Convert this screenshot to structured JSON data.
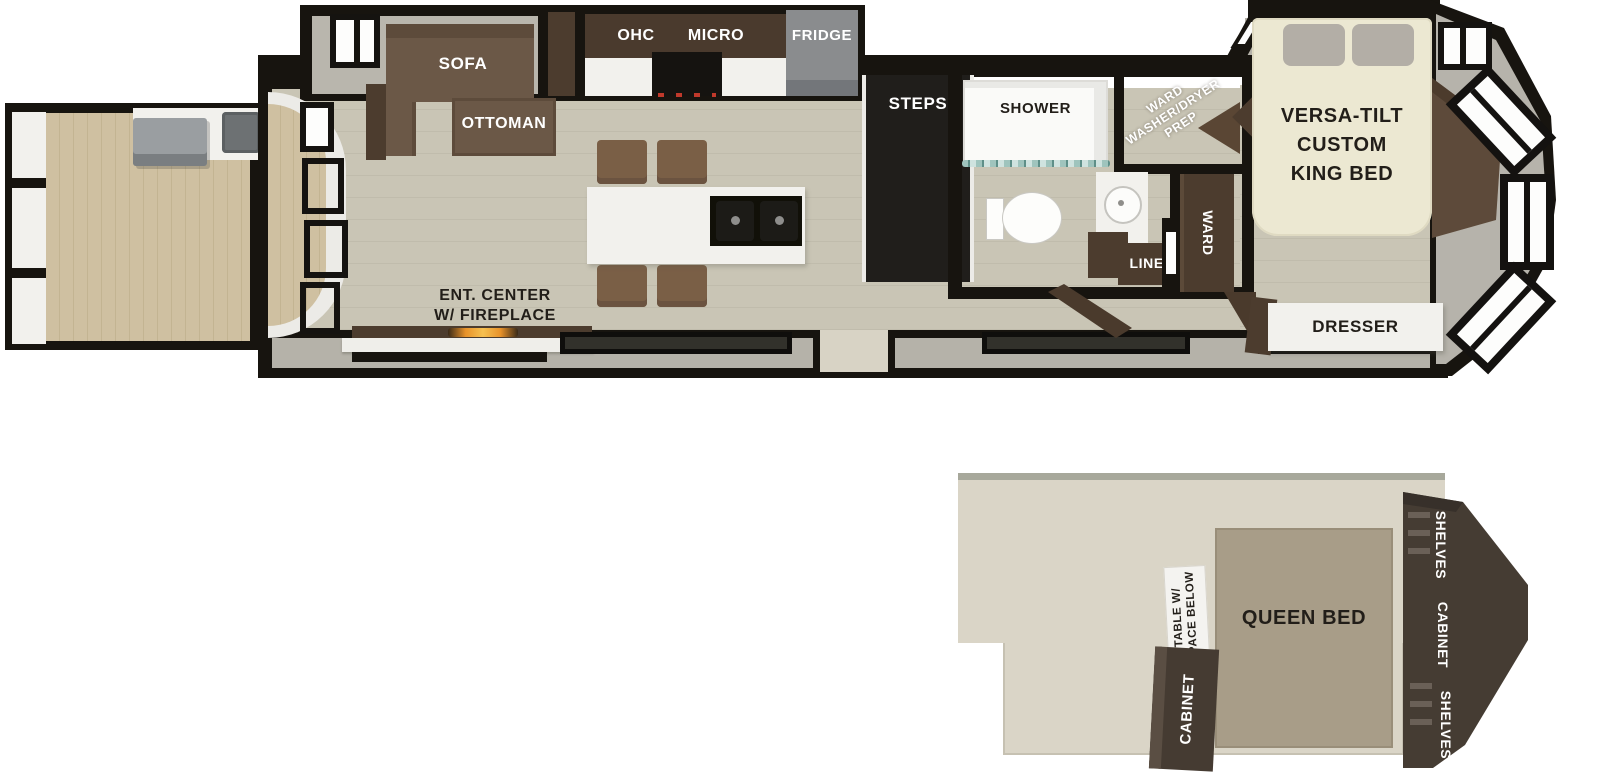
{
  "palette": {
    "wall": "#17140f",
    "floor_plank": "#c8c4b4",
    "deck_plank": "#cfc0a1",
    "slide_gray": "#b9b6ad",
    "furniture_brown": "#6b5847",
    "cabinet_dark_brown": "#4c3c2e",
    "loft_floor": "#dad5c7",
    "queen_bed_tan": "#a89d88",
    "white_counter": "#f2f1ed",
    "fireplace_glow": "#f0a43a"
  },
  "main_floor": {
    "living": {
      "sofa": "SOFA",
      "ottoman": "OTTOMAN",
      "ent_center": "ENT. CENTER\nW/ FIREPLACE"
    },
    "kitchen": {
      "ohc": "OHC",
      "micro": "MICRO",
      "fridge": "FRIDGE"
    },
    "steps": "STEPS",
    "bath": {
      "shower": "SHOWER",
      "linen": "LINEN"
    },
    "utility": {
      "ward_wd_prep": "WARD\nWASHER/DRYER\nPREP",
      "ward": "WARD"
    },
    "bedroom": {
      "king_bed": "VERSA-TILT\nCUSTOM\nKING BED",
      "dresser": "DRESSER"
    }
  },
  "loft": {
    "queen_bed": "QUEEN BED",
    "table": "TABLE W/\nSPACE BELOW",
    "cabinet": "CABINET",
    "storage": {
      "shelves_top": "SHELVES",
      "cabinet": "CABINET",
      "shelves_bottom": "SHELVES"
    }
  }
}
